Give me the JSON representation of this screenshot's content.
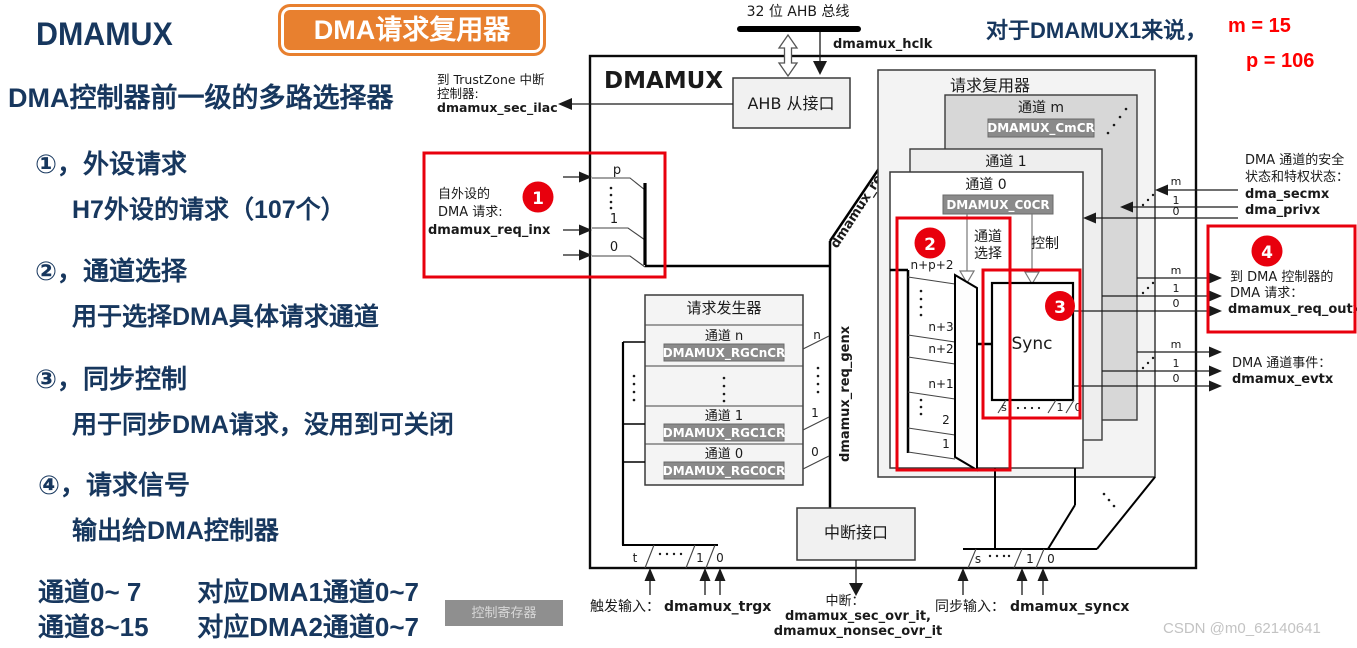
{
  "left_panel": {
    "title": "DMAMUX",
    "badge": "DMA请求复用器",
    "subtitle": "DMA控制器前一级的多路选择器",
    "items": [
      {
        "heading": "①，外设请求",
        "detail": "H7外设的请求（107个）"
      },
      {
        "heading": "②，通道选择",
        "detail": "用于选择DMA具体请求通道"
      },
      {
        "heading": "③，同步控制",
        "detail": "用于同步DMA请求，没用到可关闭"
      },
      {
        "heading": "④，请求信号",
        "detail": "输出给DMA控制器"
      }
    ],
    "mapping": [
      {
        "range": "通道0~ 7",
        "target": "对应DMA1通道0~7"
      },
      {
        "range": "通道8~15",
        "target": "对应DMA2通道0~7"
      }
    ],
    "control_register_badge": "控制寄存器"
  },
  "note": {
    "prefix": "对于DMAMUX1来说，",
    "m_value": "m = 15",
    "p_value": "p = 106"
  },
  "annotations": {
    "a1": "1",
    "a2": "2",
    "a3": "3",
    "a4": "4"
  },
  "diagram": {
    "bus_label": "32 位 AHB 总线",
    "hclk": "dmamux_hclk",
    "block_title": "DMAMUX",
    "ahb_slave": "AHB 从接口",
    "tz_line1": "到 TrustZone 中断",
    "tz_line2": "控制器:",
    "tz_line3": "dmamux_sec_ilac",
    "periph_line1": "自外设的",
    "periph_line2": "DMA 请求:",
    "periph_line3": "dmamux_req_inx",
    "p": "p",
    "one": "1",
    "zero": "0",
    "two": "2",
    "m": "m",
    "n": "n",
    "t": "t",
    "s": "s",
    "req_mux_title": "请求复用器",
    "channel_m": "通道 m",
    "channel_1": "通道 1",
    "channel_0": "通道 0",
    "channel_n": "通道 n",
    "reg_cmcr": "DMAMUX_CmCR",
    "reg_c0cr": "DMAMUX_C0CR",
    "reg_rgcncr": "DMAMUX_RGCnCR",
    "reg_rgc1cr": "DMAMUX_RGC1CR",
    "reg_rgc0cr": "DMAMUX_RGC0CR",
    "sel_line1": "通道",
    "sel_line2": "选择",
    "control": "控制",
    "sync": "Sync",
    "n_p_2": "n+p+2",
    "n_3": "n+3",
    "n_2": "n+2",
    "n_1": "n+1",
    "reqx": "dmamux_reqx",
    "req_genx": "dmamux_req_genx",
    "req_gen_title": "请求发生器",
    "irq_if": "中断接口",
    "trig_label": "触发输入：",
    "trig_signal": "dmamux_trgx",
    "irq_label": "中断：",
    "irq_signal1": "dmamux_sec_ovr_it,",
    "irq_signal2": "dmamux_nonsec_ovr_it",
    "sync_label": "同步输入：",
    "sync_signal": "dmamux_syncx",
    "sec_line1": "DMA 通道的安全",
    "sec_line2": "状态和特权状态：",
    "sec_signal": "dma_secmx",
    "priv_signal": "dma_privx",
    "out_line1": "到 DMA 控制器的",
    "out_line2": "DMA 请求：",
    "out_signal": "dmamux_req_outx",
    "evt_line1": "DMA 通道事件：",
    "evt_signal": "dmamux_evtx"
  },
  "watermark": "CSDN @m0_62140641",
  "colors": {
    "navy": "#17375E",
    "orange": "#E8802F",
    "red": "#E8000D",
    "note_red": "#FF0000"
  }
}
